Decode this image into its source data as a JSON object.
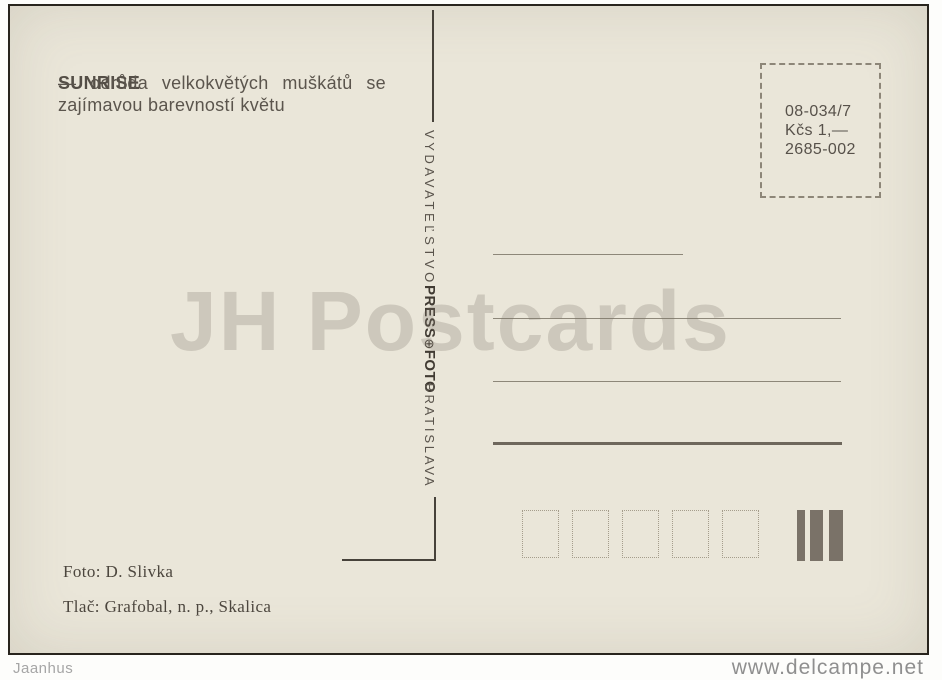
{
  "postcard": {
    "description": {
      "title": "SUNRISE",
      "rest": " — odrůda velkokvětých muškátů se zajímavou barevností květu"
    },
    "stamp_box": {
      "lines": [
        "08-034/7",
        "Kčs 1,—",
        "2685-002"
      ]
    },
    "publisher": {
      "name": "VYDAVATEĽSTVO",
      "logo_press": "PRESS",
      "logo_globe": "⊕",
      "logo_foto": "FOTO",
      "city": "BRATISLAVA"
    },
    "credits": {
      "photo": "Foto: D. Slivka",
      "print": "Tlač: Grafobal, n. p., Skalica"
    },
    "colors": {
      "paper": "#eae6d9",
      "ink": "#57514a",
      "address_line": "#8d8779",
      "thick_line": "#6e675c",
      "cancellation_bar": "#7a7268"
    }
  },
  "watermark": "JH Postcards",
  "footer": {
    "seller": "Jaanhus",
    "site": "www.delcampe.net"
  }
}
